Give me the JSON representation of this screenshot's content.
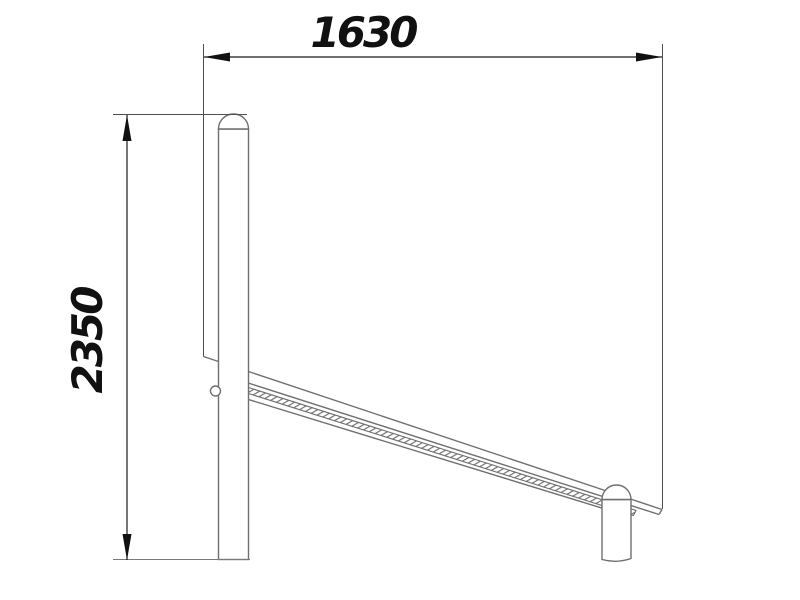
{
  "drawing": {
    "kind": "technical-dimension-drawing-side-view",
    "dimensions": {
      "width": {
        "value": "1630",
        "orientation": "horizontal",
        "position": "top"
      },
      "height": {
        "value": "2350",
        "orientation": "vertical",
        "position": "left"
      }
    },
    "colors": {
      "background": "#ffffff",
      "object_line": "#6f6f6f",
      "extension_line": "#4f4f4f",
      "dimension_line": "#1b1b1b",
      "arrow_fill": "#111111",
      "text": "#111111"
    },
    "components": [
      "tall-post-with-round-cap-left",
      "short-post-with-round-cap-right",
      "inclined-board-with-hatched-edge",
      "attachment-ring-on-left-post"
    ]
  }
}
